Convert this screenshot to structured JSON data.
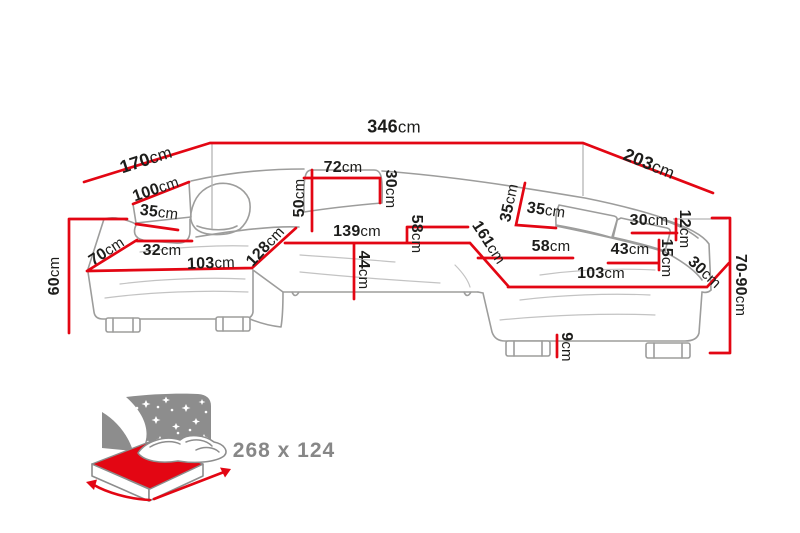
{
  "diagram": {
    "title": "corner-sofa-dimension-diagram",
    "colors": {
      "accent": "#e30613",
      "sofa_line": "#9d9d9c",
      "sofa_line_light": "#c3c3c3",
      "extension_line": "#b5b5b5",
      "label": "#1d1d1b",
      "muted_label": "#878787",
      "bed_gray": "#8d8d8d"
    },
    "dimension_labels": [
      {
        "value": "346",
        "unit": "cm",
        "x": 394,
        "y": 127,
        "rot": 0,
        "size": "lg"
      },
      {
        "value": "170",
        "unit": "cm",
        "x": 146,
        "y": 160,
        "rot": -18,
        "size": "lg"
      },
      {
        "value": "203",
        "unit": "cm",
        "x": 649,
        "y": 164,
        "rot": 22,
        "size": "lg"
      },
      {
        "value": "100",
        "unit": "cm",
        "x": 156,
        "y": 190,
        "rot": -19,
        "size": "md"
      },
      {
        "value": "35",
        "unit": "cm",
        "x": 159,
        "y": 213,
        "rot": 7,
        "size": "md"
      },
      {
        "value": "70",
        "unit": "cm",
        "x": 107,
        "y": 252,
        "rot": -33,
        "size": "md"
      },
      {
        "value": "32",
        "unit": "cm",
        "x": 162,
        "y": 251,
        "rot": 0,
        "size": "md"
      },
      {
        "value": "103",
        "unit": "cm",
        "x": 211,
        "y": 264,
        "rot": -2,
        "size": "md"
      },
      {
        "value": "60",
        "unit": "cm",
        "x": 55,
        "y": 276,
        "rot": -90,
        "size": "md"
      },
      {
        "value": "50",
        "unit": "cm",
        "x": 300,
        "y": 198,
        "rot": -90,
        "size": "md"
      },
      {
        "value": "72",
        "unit": "cm",
        "x": 343,
        "y": 168,
        "rot": 0,
        "size": "md"
      },
      {
        "value": "30",
        "unit": "cm",
        "x": 390,
        "y": 189,
        "rot": 90,
        "size": "md"
      },
      {
        "value": "139",
        "unit": "cm",
        "x": 357,
        "y": 232,
        "rot": 0,
        "size": "md"
      },
      {
        "value": "128",
        "unit": "cm",
        "x": 266,
        "y": 247,
        "rot": -47,
        "size": "md"
      },
      {
        "value": "58",
        "unit": "cm",
        "x": 416,
        "y": 234,
        "rot": 90,
        "size": "md"
      },
      {
        "value": "44",
        "unit": "cm",
        "x": 363,
        "y": 270,
        "rot": 90,
        "size": "md"
      },
      {
        "value": "35",
        "unit": "cm",
        "x": 510,
        "y": 203,
        "rot": -78,
        "size": "md"
      },
      {
        "value": "35",
        "unit": "cm",
        "x": 546,
        "y": 211,
        "rot": 8,
        "size": "md"
      },
      {
        "value": "161",
        "unit": "cm",
        "x": 488,
        "y": 243,
        "rot": 57,
        "size": "md"
      },
      {
        "value": "58",
        "unit": "cm",
        "x": 551,
        "y": 247,
        "rot": 0,
        "size": "md"
      },
      {
        "value": "43",
        "unit": "cm",
        "x": 630,
        "y": 250,
        "rot": 0,
        "size": "md"
      },
      {
        "value": "30",
        "unit": "cm",
        "x": 649,
        "y": 221,
        "rot": 0,
        "size": "md"
      },
      {
        "value": "12",
        "unit": "cm",
        "x": 684,
        "y": 229,
        "rot": 90,
        "size": "md"
      },
      {
        "value": "15",
        "unit": "cm",
        "x": 666,
        "y": 258,
        "rot": 90,
        "size": "md"
      },
      {
        "value": "103",
        "unit": "cm",
        "x": 601,
        "y": 274,
        "rot": 0,
        "size": "md"
      },
      {
        "value": "30",
        "unit": "cm",
        "x": 704,
        "y": 273,
        "rot": 43,
        "size": "md"
      },
      {
        "value": "70-90",
        "unit": "cm",
        "x": 740,
        "y": 285,
        "rot": 90,
        "size": "md"
      },
      {
        "value": "9",
        "unit": "cm",
        "x": 566,
        "y": 347,
        "rot": 90,
        "size": "md"
      }
    ],
    "bed": {
      "label": "268 x 124",
      "icon_name": "sofa-bed-sleeping-function-icon"
    }
  }
}
